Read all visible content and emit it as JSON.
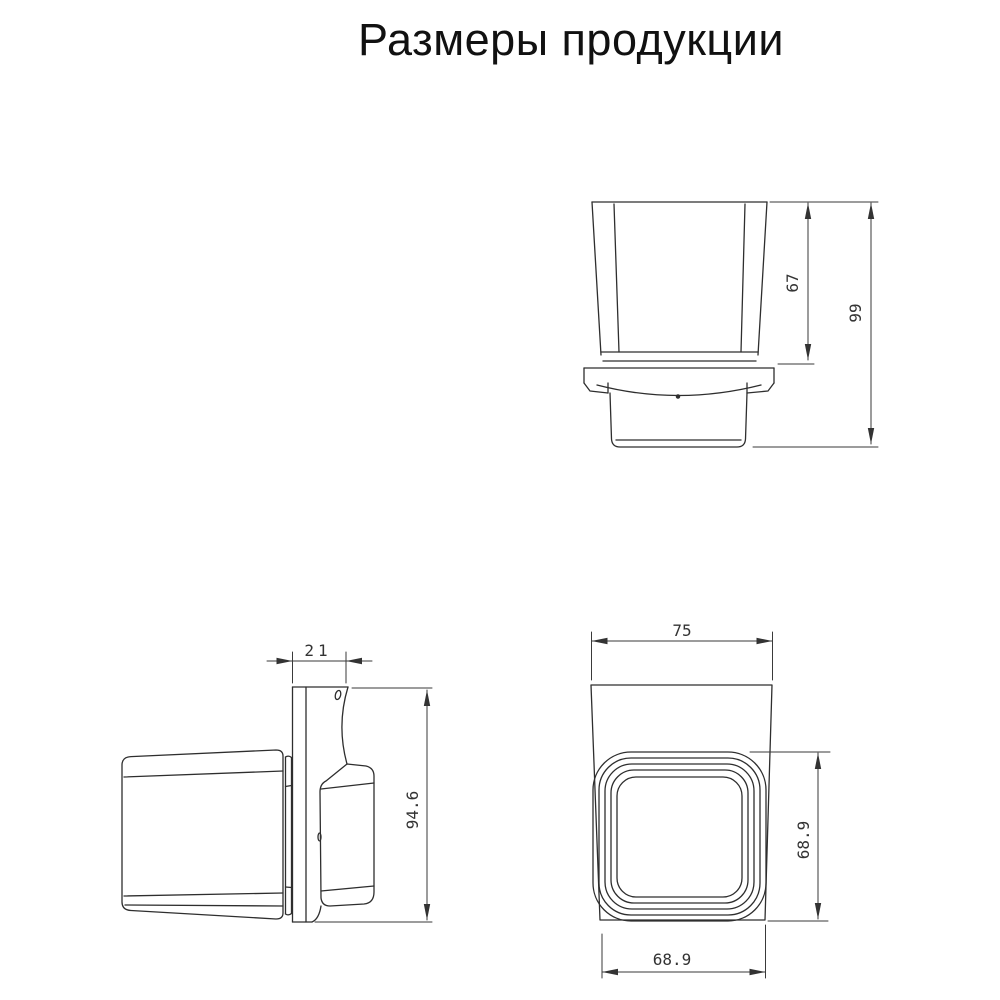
{
  "title": "Размеры продукции",
  "views": {
    "front": {
      "description": "front-view-cup-in-holder",
      "dim_cup_height": "67",
      "dim_total_height": "99"
    },
    "side": {
      "description": "side-view-wall-plate-and-bracket",
      "dim_depth": "21",
      "dim_plate_height": "94.6"
    },
    "top": {
      "description": "top-view-cup-opening",
      "dim_top_width": "75",
      "dim_side_depth": "68.9",
      "dim_bottom_width": "68.9"
    }
  },
  "colors": {
    "background": "#ffffff",
    "line": "#2e2e2e",
    "dimension_line": "#3a3a3a",
    "dimension_text": "#333333",
    "title_text": "#111111"
  }
}
